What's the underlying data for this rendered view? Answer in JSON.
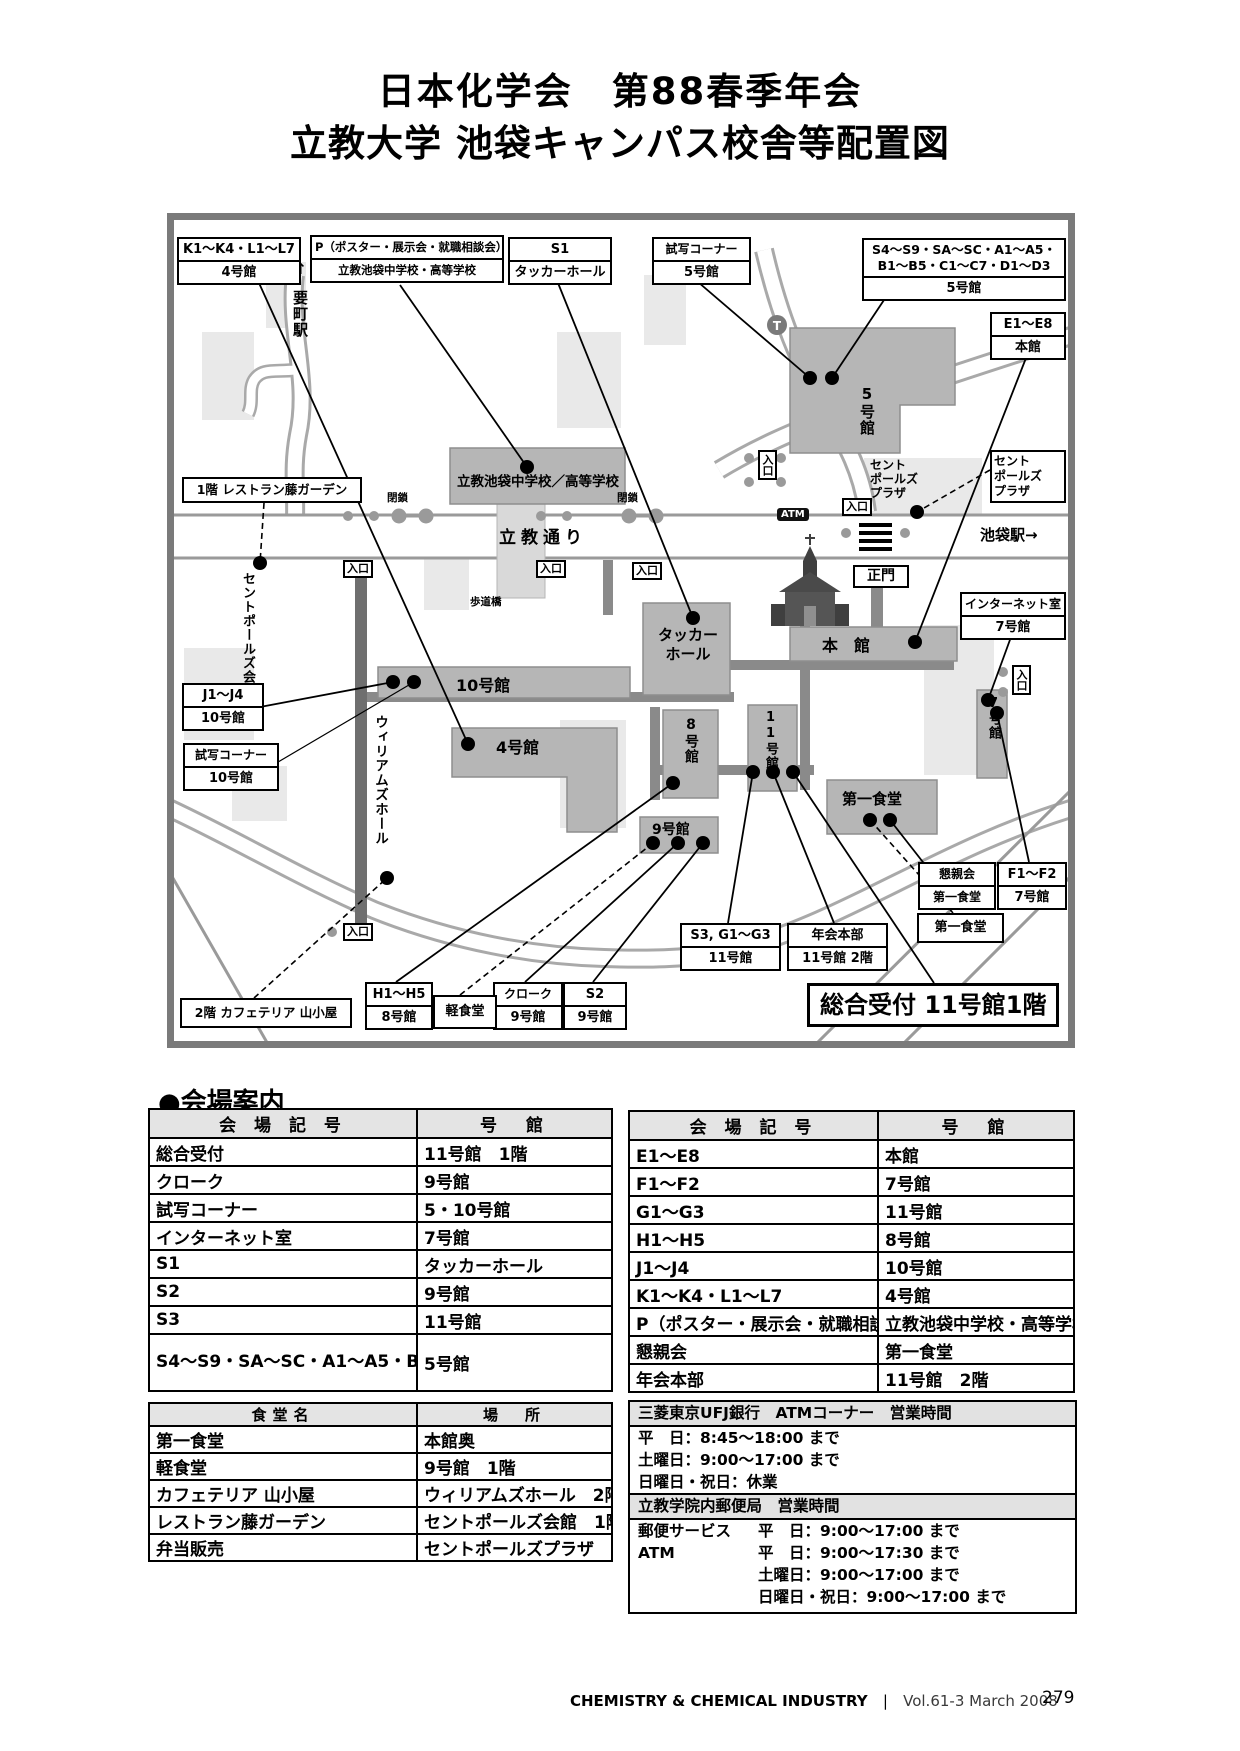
{
  "title": {
    "line1": "日本化学会　第88春季年会",
    "line2": "立教大学 池袋キャンパス校舎等配置図"
  },
  "map": {
    "callouts": {
      "kl": {
        "code": "K1～K4・L1～L7",
        "building": "4号館"
      },
      "p": {
        "code": "P（ポスター・展示会・就職相談会）",
        "building": "立教池袋中学校・高等学校"
      },
      "s1": {
        "code": "S1",
        "building": "タッカーホール"
      },
      "shisha5": {
        "code": "試写コーナー",
        "building": "5号館"
      },
      "s4": {
        "code1": "S4～S9・SA～SC・A1～A5・",
        "code2": "B1～B5・C1～C7・D1～D3",
        "building": "5号館"
      },
      "e": {
        "code": "E1～E8",
        "building": "本館"
      },
      "internet": {
        "code": "インターネット室",
        "building": "7号館"
      },
      "j": {
        "code": "J1～J4",
        "building": "10号館"
      },
      "shisha10": {
        "code": "試写コーナー",
        "building": "10号館"
      },
      "h": {
        "code": "H1～H5",
        "building": "8号館"
      },
      "cloak": {
        "code": "クローク",
        "building": "9号館"
      },
      "s2": {
        "code": "S2",
        "building": "9号館"
      },
      "s3": {
        "code": "S3, G1～G3",
        "building": "11号館"
      },
      "honbu": {
        "code": "年会本部",
        "building": "11号館 2階"
      },
      "konshin": {
        "code": "懇親会",
        "building": "第一食堂"
      },
      "f": {
        "code": "F1～F2",
        "building": "7号館"
      },
      "restaurant": "1階 レストラン藤ガーデン",
      "cafeteria": "2階 カフェテリア 山小屋",
      "light_meal": "軽食堂",
      "daiichi": "第一食堂",
      "reception": "総合受付 11号館1階"
    },
    "buildings": {
      "b5": "5号館",
      "school": "立教池袋中学校／高等学校",
      "tucker1": "タッカー",
      "tucker2": "ホール",
      "main": "本　館",
      "b10": "10号館",
      "b4": "4号館",
      "b8": "8号館",
      "b11": "11号館",
      "b9": "9号館",
      "b7": "7号館",
      "daiichi": "第一食堂"
    },
    "texts": {
      "arrow_up": "↑",
      "kanamecho": "要町駅",
      "rikkyo_dori": "立教通り",
      "ikebukuro": "池袋駅→",
      "hodokyo": "歩道橋",
      "seimon": "正門",
      "entrance": "入口",
      "closed": "閉鎖",
      "atm": "ATM",
      "stpauls_kaikan": "セントポールズ会館",
      "williams": "ウィリアムズホール",
      "plaza1": "セント",
      "plaza2": "ポールズ",
      "plaza3": "プラザ"
    }
  },
  "venue_guide": {
    "heading": "●会場案内",
    "col_code": "会 場 記 号",
    "col_bldg": "号　館",
    "left_rows": [
      {
        "c": "総合受付",
        "b": "11号館　1階"
      },
      {
        "c": "クローク",
        "b": "9号館"
      },
      {
        "c": "試写コーナー",
        "b": "5・10号館"
      },
      {
        "c": "インターネット室",
        "b": "7号館"
      },
      {
        "c": "S1",
        "b": "タッカーホール"
      },
      {
        "c": "S2",
        "b": "9号館"
      },
      {
        "c": "S3",
        "b": "11号館"
      },
      {
        "c": "S4～S9・SA～SC・A1～A5・B1～B5・C1～C7・D1～D3",
        "b": "5号館"
      }
    ],
    "right_rows": [
      {
        "c": "E1～E8",
        "b": "本館"
      },
      {
        "c": "F1～F2",
        "b": "7号館"
      },
      {
        "c": "G1～G3",
        "b": "11号館"
      },
      {
        "c": "H1～H5",
        "b": "8号館"
      },
      {
        "c": "J1～J4",
        "b": "10号館"
      },
      {
        "c": "K1～K4・L1～L7",
        "b": "4号館"
      },
      {
        "c": "P（ポスター・展示会・就職相談会）",
        "b": "立教池袋中学校・高等学校"
      },
      {
        "c": "懇親会",
        "b": "第一食堂"
      },
      {
        "c": "年会本部",
        "b": "11号館　2階"
      }
    ]
  },
  "dining": {
    "col_name": "食堂名",
    "col_place": "場　所",
    "rows": [
      {
        "n": "第一食堂",
        "p": "本館奥"
      },
      {
        "n": "軽食堂",
        "p": "9号館　1階"
      },
      {
        "n": "カフェテリア 山小屋",
        "p": "ウィリアムズホール　2階"
      },
      {
        "n": "レストラン藤ガーデン",
        "p": "セントポールズ会館　1階"
      },
      {
        "n": "弁当販売",
        "p": "セントポールズプラザ"
      }
    ]
  },
  "hours": {
    "bank_header": "三菱東京UFJ銀行　ATMコーナー　営業時間",
    "bank_lines": [
      "平　日：8:45～18:00 まで",
      "土曜日：9:00～17:00 まで",
      "日曜日・祝日：休業"
    ],
    "post_header": "立教学院内郵便局　営業時間",
    "post_lines": [
      {
        "label": "郵便サービス",
        "text": "平　日：9:00～17:00 まで"
      },
      {
        "label": "ATM",
        "text": "平　日：9:00～17:30 まで"
      },
      {
        "label": "",
        "text": "土曜日：9:00～17:00 まで"
      },
      {
        "label": "",
        "text": "日曜日・祝日：9:00～17:00 まで"
      }
    ]
  },
  "footer": {
    "journal": "CHEMISTRY & CHEMICAL INDUSTRY",
    "separator": "|",
    "volume": "Vol.61-3 March 2008",
    "page": "279"
  }
}
